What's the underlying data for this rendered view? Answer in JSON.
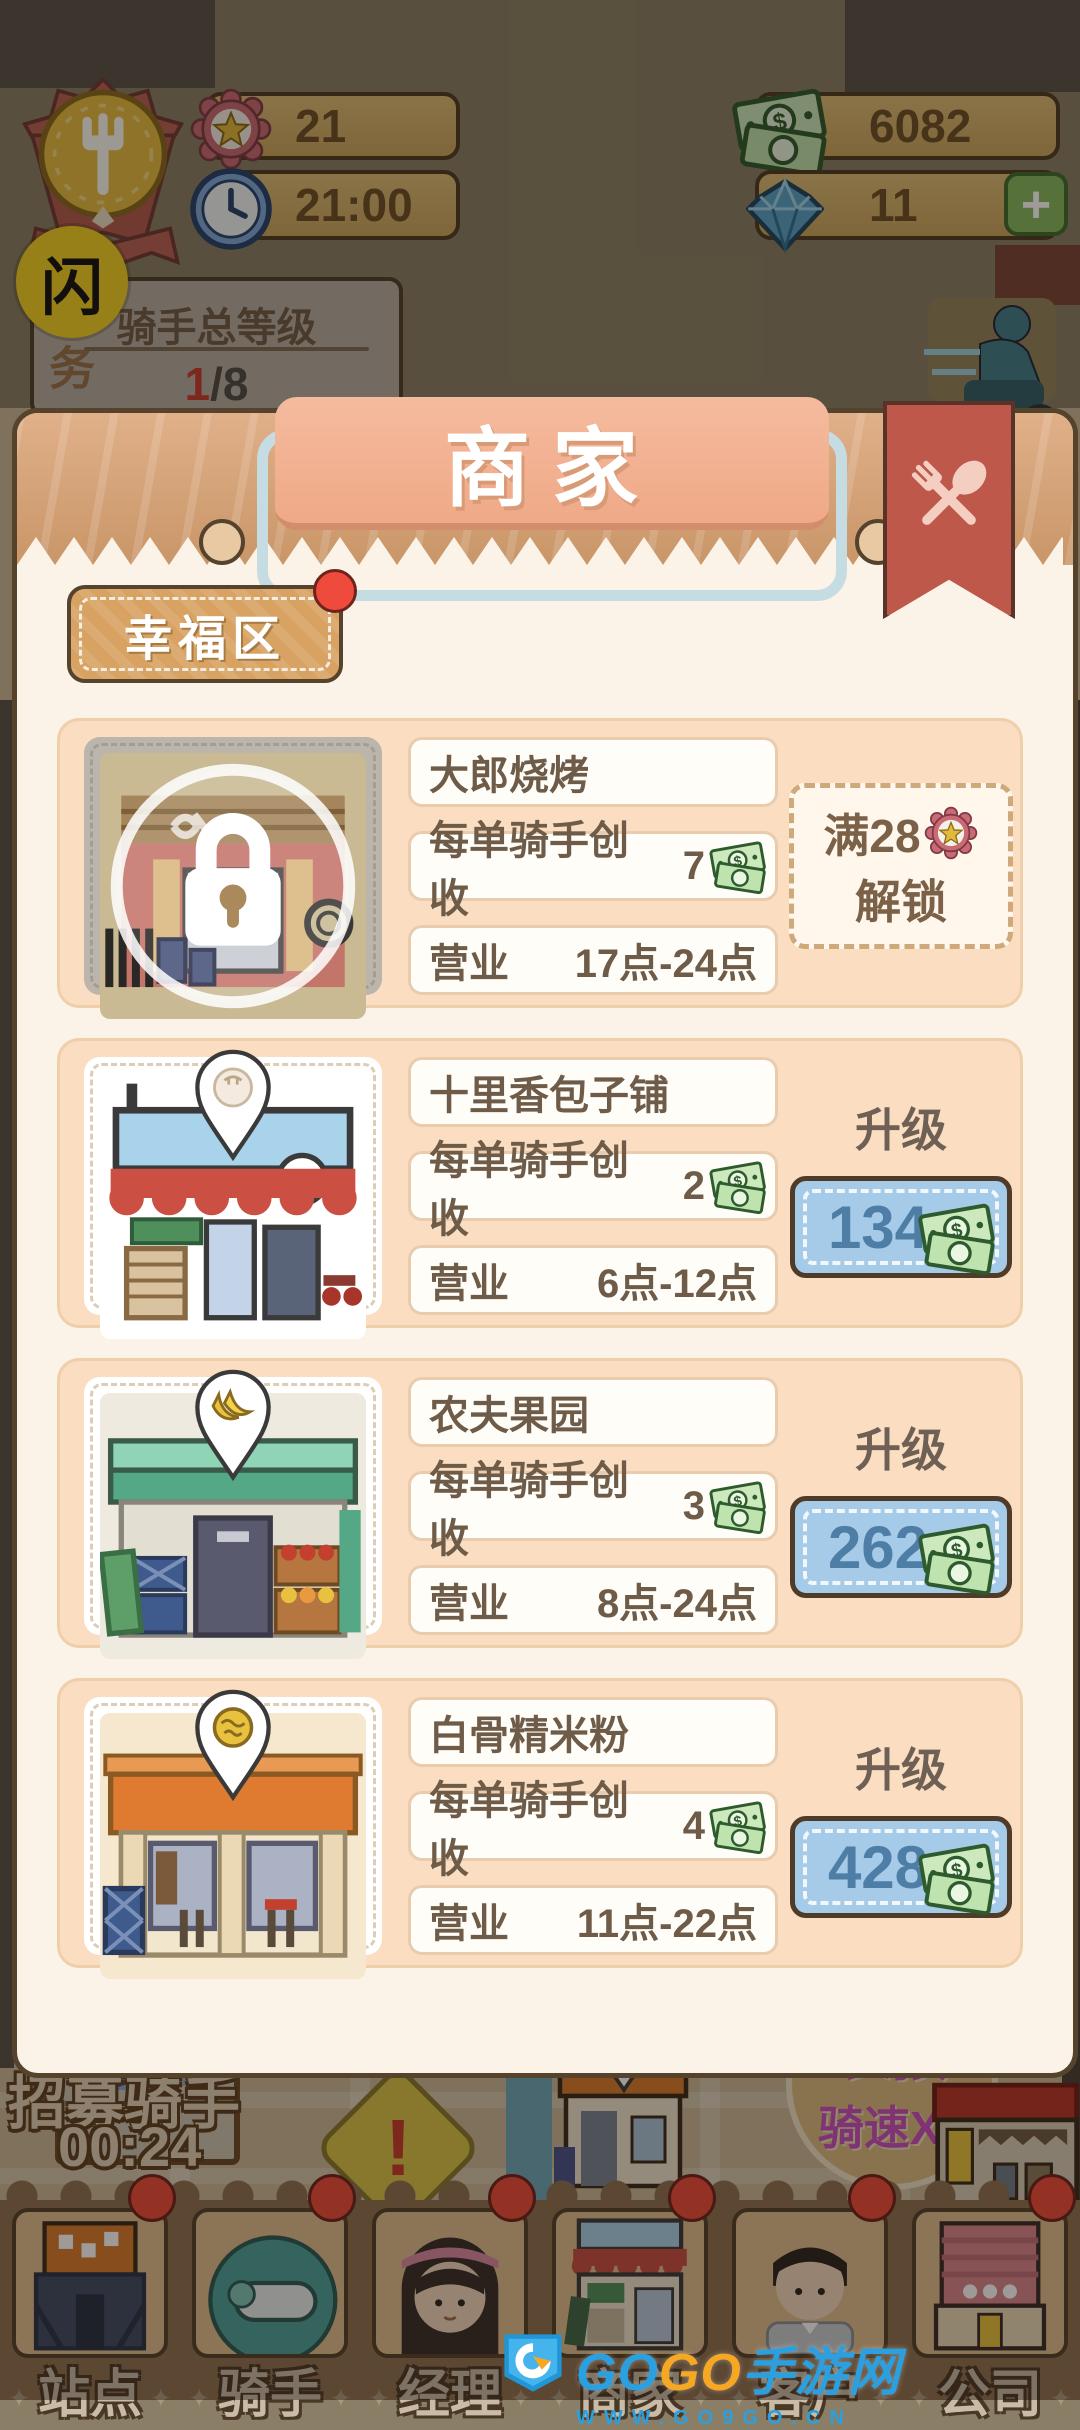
{
  "hud": {
    "star_count": "21",
    "time": "21:00",
    "money": "6082",
    "diamonds": "11",
    "add_label": "+",
    "flash_label": "闪",
    "task": {
      "side_label": "任务",
      "title": "骑手总等级",
      "progress_current": "1",
      "progress_total": "/8"
    }
  },
  "modal": {
    "title": "商家",
    "district_tab": "幸福区",
    "labels": {
      "income": "每单骑手创收",
      "hours": "营业",
      "upgrade": "升级"
    },
    "shops": [
      {
        "name": "大郎烧烤",
        "income": "7",
        "hours": "17点-24点",
        "locked": true,
        "unlock_req": "满28",
        "unlock_action": "解锁"
      },
      {
        "name": "十里香包子铺",
        "income": "2",
        "hours": "6点-12点",
        "upgrade_cost": "134"
      },
      {
        "name": "农夫果园",
        "income": "3",
        "hours": "8点-24点",
        "upgrade_cost": "262"
      },
      {
        "name": "白骨精米粉",
        "income": "4",
        "hours": "11点-22点",
        "upgrade_cost": "428"
      }
    ]
  },
  "map": {
    "recruit_label": "招募骑手",
    "recruit_timer": "00:24",
    "alert": "!",
    "boost_line1": "长按",
    "boost_line2": "骑速X2"
  },
  "nav": {
    "items": [
      {
        "label": "站点"
      },
      {
        "label": "骑手"
      },
      {
        "label": "经理"
      },
      {
        "label": "商家"
      },
      {
        "label": "客户"
      },
      {
        "label": "公司"
      }
    ]
  },
  "watermark": {
    "brand_part1": "GO",
    "brand_part2": "GO",
    "brand_cn": "手游网",
    "url": "WWW.GO9GO.CN"
  },
  "colors": {
    "accent_red": "#BE584A",
    "gold_bar": "#D9B670",
    "upgrade_blue": "#A6CBE8",
    "money_green": "#CBE9BC",
    "notify_red": "#EF4B3C"
  }
}
